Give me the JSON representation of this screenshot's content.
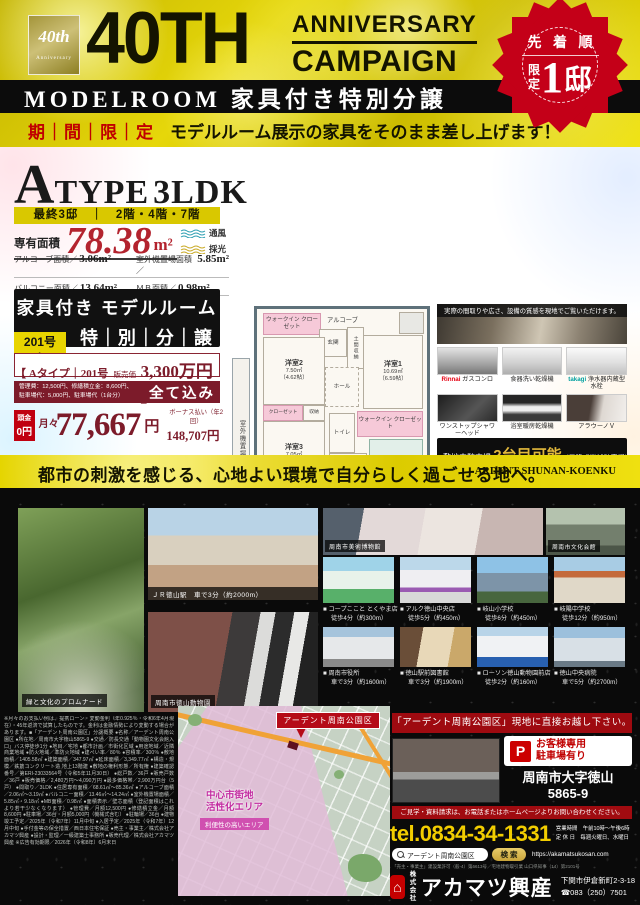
{
  "ui": {
    "bullet": "■"
  },
  "colors": {
    "gold": "#e6d70a",
    "badge_red": "#c40018",
    "maroon": "#7c1b2a",
    "yellow_band": "#e5d500",
    "black": "#0a0a0a"
  },
  "header": {
    "logo_line1": "40th",
    "logo_line2": "Anniversary",
    "big": "40TH",
    "anniv": "ANNIVERSARY",
    "campaign": "CAMPAIGN",
    "band": "MODELROOM 家具付き特別分譲",
    "limited": "期｜間｜限｜定",
    "subtitle": "モデルルーム展示の家具をそのまま差し上げます！",
    "badge_top": "先 着 順",
    "badge_gentei1": "限",
    "badge_gentei2": "定",
    "badge_num": "1",
    "badge_tei": "邸"
  },
  "atype": {
    "a": "A",
    "type": "TYPE",
    "ldk": "3LDK",
    "availability": "最終3邸　｜　2階・4階・7階",
    "senyu_label": "専有面積",
    "senyu_value": "78.38",
    "senyu_unit": "m²",
    "wind": "通風",
    "light": "採光",
    "specs": [
      {
        "label": "アルコーブ面積／",
        "value": "3.06m²"
      },
      {
        "label": "室外機置場面積／",
        "value": "5.85m²"
      },
      {
        "label": "バルコニー面積／",
        "value": "13.64m²"
      },
      {
        "label": "ＭＢ面積／",
        "value": "0.98m²"
      }
    ],
    "kagu_line": "家具付き モデルルーム",
    "room_chip": "201号室",
    "tokubetsu": "特｜別｜分｜譲｜中",
    "price_prefix": "【 Aタイプ｜201号室｜",
    "price_label": "販売価格",
    "price_value": "3,300万円 】",
    "fees_line1": "管理費：12,500円、修繕積立金：8,600円、",
    "fees_line2": "駐車場代：5,000円、駐車場代（1台分）",
    "all_included": "全て込み",
    "atamakin_label": "頭金",
    "atamakin_value": "0円",
    "monthly_label": "月々",
    "monthly_value": "77,667",
    "monthly_unit": "円",
    "bonus_label": "ボーナス払い（年2回）",
    "bonus_value": "148,707円"
  },
  "floorplan": {
    "wic1": "ウォークイン クローゼット",
    "alcove": "アルコーブ",
    "genkan": "玄関",
    "doma": "土間収納",
    "room2": "洋室2",
    "room2_size": "7.50㎡",
    "room2_jo": "（4.62帖）",
    "hall": "ホール",
    "room1": "洋室1",
    "room1_size": "10.69㎡",
    "room1_jo": "（6.59帖）",
    "closet": "クローゼット",
    "shuno": "収納",
    "room3": "洋室3",
    "room3_size": "7.05㎡",
    "room3_jo": "（4.35帖）",
    "toilet": "トイレ",
    "wic2": "ウォークイン クローゼット",
    "senmen": "洗面室",
    "bath": "浴室",
    "bath_size": "1418",
    "ldk": "LDK",
    "ldk_size": "28.86㎡",
    "ldk_jo": "（17.83帖）",
    "monohoshi": "室内物干し",
    "balcony": "バルコニー",
    "balcony_depth": "約1.8m",
    "outdoor": "室外機置場"
  },
  "showroom": {
    "caption": "実際の間取りや広さ、設備の質感を現地でご覧いただけます。"
  },
  "equipment": [
    {
      "brand": "Rinnai",
      "name": " ガスコンロ"
    },
    {
      "brand": "",
      "name": "食器洗い乾燥機"
    },
    {
      "brand": "takagi",
      "name": " 浄水器内蔵型水栓"
    },
    {
      "brand": "",
      "name": "ワンストップシャワーヘッド"
    },
    {
      "brand": "",
      "name": "浴室暖房乾燥機"
    },
    {
      "brand": "",
      "name": "アラウーノＶ"
    }
  ],
  "parking": {
    "line1_a": "敷地内駐車場 ",
    "line1_b": "2台目可能",
    "line1_c": "（昇降式機械駐車場）",
    "line2_a": "敷地外駐車有り",
    "line2_b": "（徒歩2分）"
  },
  "achievement": {
    "small": "アーデントマンション",
    "area": "周南エリア",
    "debut": "初登場",
    "lead": "おかげさまで、アーデントシリーズ",
    "n1": "2,507",
    "n2": "邸（",
    "n3": "71",
    "n4": "棟）を",
    "line2": "数えるまでになりました。"
  },
  "cityband": {
    "jp": "都市の刺激を感じる、心地よい環境で自分らしく過ごせる地へ。",
    "en": "ARDENT SHUNAN-KOENKU"
  },
  "photos": {
    "promenade": "緑と文化のプロムナード",
    "station": "ＪＲ徳山駅　車で3分（約2000m）",
    "zoo": "周南市徳山動物園",
    "museum": "周南市美術博物館",
    "bunka": "周南市文化会館"
  },
  "facilities": [
    {
      "name": "コープここと とくやま店",
      "access": "徒歩4分（約300m）"
    },
    {
      "name": "アルク徳山中央店",
      "access": "徒歩5分（約450m）"
    },
    {
      "name": "岐山小学校",
      "access": "徒歩6分（約450m）"
    },
    {
      "name": "岐陽中学校",
      "access": "徒歩12分（約950m）"
    },
    {
      "name": "周南市役所",
      "access": "車で3分（約1600m）"
    },
    {
      "name": "徳山駅前図書館",
      "access": "車で3分（約1900m）"
    },
    {
      "name": "ローソン徳山動物園前店",
      "access": "徒歩2分（約160m）"
    },
    {
      "name": "徳山中央病院",
      "access": "車で5分（約2700m）"
    }
  ],
  "fineprint": "※月々のお支払い例は、提携ローン・変動金利（年0.925％・令和6年4月現在）・45年返済で試算したものです。金利は金融情勢により変動する場合があります。■「アーデント周南公園区」分譲概要 ●名称／アーデント周南公園区 ●所在地／周南市大字徳山5865-9 ●交通／防長交通「動物園文化会館入口」バス停徒歩1分 ●地目／宅地 ●都市計画／市街化区域 ●用途地域／近隣商業地域 ●防火地域／準防火地域 ●建ぺい率／80％ ●容積率／300％ ●敷地面積／1405.58㎡ ●建築面積／347.97㎡ ●延床面積／3,349.77㎡ ●構造・規模／鉄筋コンクリート造 地上13階建 ●敷地の権利形態／所有権 ●建築確認番号／第ERI-23033564号（令和5年11月30日） ●総戸数／36戸 ●販売戸数／36戸 ●販売価格／2,480万円～4,090万円 ●最多価格帯／2,900万円台（5戸） ●間取り／3LDK ●住居専有面積／68.61㎡～85.36㎡ ●アルコーブ面積／2.06㎡～3.19㎡ ●バルコニー面積／13.46㎡～14.24㎡ ●室外機置場面積／5.85㎡・9.18㎡ ●MB面積／0.98㎡ ●面積表示／壁芯面積（登記面積はこれより若干少なくなります） ●管理費／月額12,500円 ●修繕積立金／月額8,600円 ●駐車場／36台・月額5,000円（機械式含む） ●駐輪場／36台 ●建物竣工予定／2025年（令和7年）11月中旬 ●入居予定／2025年（令和7年）12月中旬 ●手付金等の保全措置／西日本住宅保証 ●売主・事業主／株式会社アカマツ興産 ●設計・監理／一級建築士事務所 ●販売代理／株式会社アカマツ興産 ※広告有効期限／2026年（令和8年）6月末日",
  "map": {
    "title": "アーデント周南公園区",
    "zone1": "中心市街地",
    "zone2": "活性化エリア",
    "chip": "利便性の高いエリア"
  },
  "visit": {
    "heading": "「アーデント周南公園区」現地に直接お越し下さい。",
    "p": "P",
    "p1": "お客様専用",
    "p2": "駐車場有り",
    "addr1": "周南市大字徳山",
    "addr2": "5865-9"
  },
  "contact": {
    "cta": "ご見学・資料請求は、お電話またはホームページよりお問い合わせください。",
    "tel": "tel.0834-34-1331",
    "hours1": "営業時間　午前10時～午後6時",
    "hours2": "定 休 日　毎週火曜日、水曜日",
    "search_q": "アーデント周南公園区",
    "search_btn": "検 索",
    "url": "https://akamatsukosan.com",
    "license": "「売主・事業主」建設業許可（般-4）第6613号／宅地建物取引業 山口県知事（14）第2101号"
  },
  "company": {
    "kabu1": "株式",
    "kabu2": "会社",
    "name": "アカマツ興産",
    "logo_glyph": "⌂",
    "addr": "下関市伊倉新町2-3-18",
    "tel": "☎083（250）7501"
  }
}
